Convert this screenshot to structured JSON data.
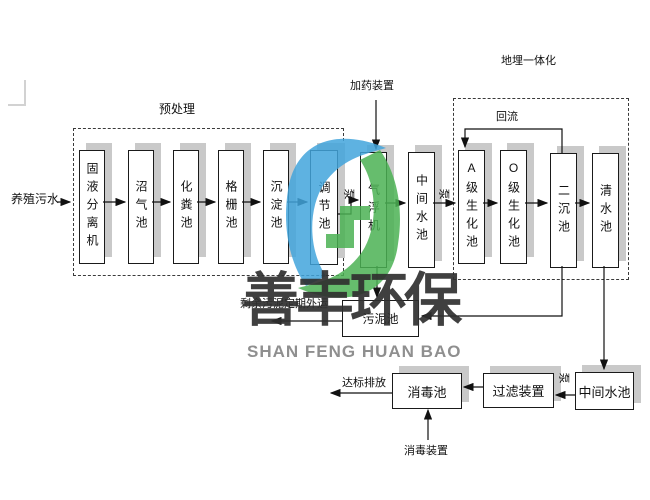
{
  "diagram": {
    "input_label": "养殖污水",
    "pretreatment_title": "预处理",
    "integrated_title": "地埋一体化",
    "reflux_label": "回流",
    "dosing_label": "加药装置",
    "disinfection_device_label": "消毒装置",
    "discharge_label": "达标排放",
    "sludge_out_label": "剩余污泥定期外运",
    "pump_label": "泵",
    "nodes": {
      "separator": "固液分离机",
      "biogas": "沼气池",
      "septic": "化粪池",
      "grille": "格栅池",
      "sedimentation": "沉淀池",
      "regulating": "调节池",
      "air_flotation": "气浮机",
      "mid_tank_1": "中间水池",
      "a_bio": "A级生化池",
      "o_bio": "O级生化池",
      "secondary_sed": "二沉池",
      "clear_water": "清水池",
      "sludge_tank": "污泥池",
      "mid_tank_2": "中间水池",
      "filter_device": "过滤装置",
      "disinfection_tank": "消毒池"
    }
  },
  "watermark": {
    "cn": "善丰环保",
    "en": "SHAN FENG HUAN BAO"
  },
  "colors": {
    "logo_blue": "#42a5dc",
    "logo_green": "#4bb254",
    "watermark_cn": "#303030",
    "watermark_en": "#8f8f8f",
    "node_shadow": "#c9c9c9"
  }
}
